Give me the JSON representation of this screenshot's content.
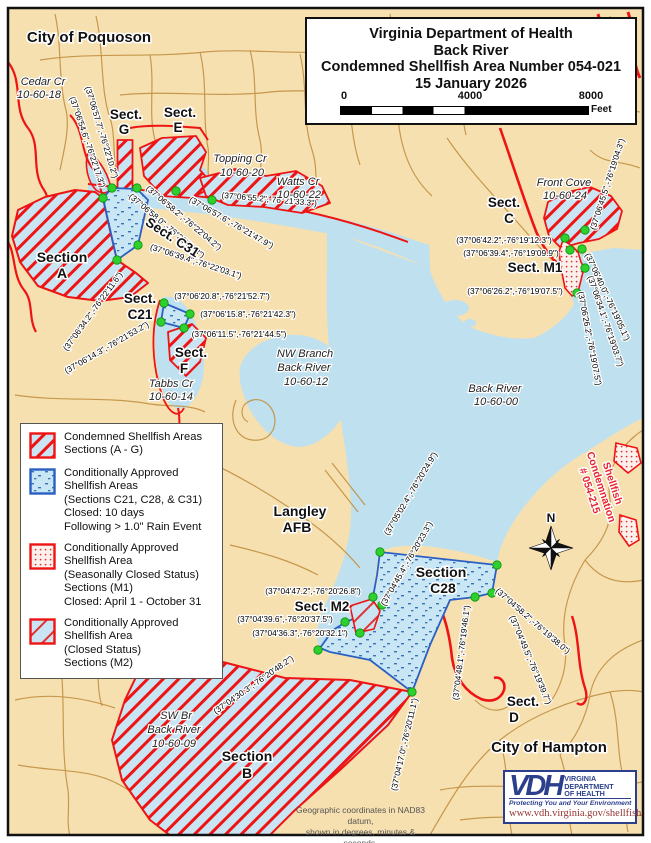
{
  "title_box": {
    "line1": "Virginia Department of Health",
    "line2": "Back River",
    "line3": "Condemned Shellfish Area Number 054-021",
    "line4": "15 January 2026",
    "scale": {
      "tick0": "0",
      "tick1": "4000",
      "tick2": "8000",
      "unit": "Feet"
    }
  },
  "legend": {
    "items": [
      {
        "swatch": "condemned",
        "lines": [
          "Condemned Shellfish Areas",
          "Sections (A - G)"
        ]
      },
      {
        "swatch": "rain",
        "lines": [
          "Conditionally Approved",
          "Shellfish Areas",
          "(Sections C21, C28, & C31)",
          "Closed: 10 days",
          "Following > 1.0\" Rain Event"
        ]
      },
      {
        "swatch": "seasonal",
        "lines": [
          "Conditionally Approved",
          "Shellfish Area",
          "(Seasonally Closed Status)",
          "Sections (M1)",
          "Closed: April 1 - October 31"
        ]
      },
      {
        "swatch": "m2",
        "lines": [
          "Conditionally Approved",
          "Shellfish Area",
          "(Closed Status)",
          "Sections (M2)"
        ]
      }
    ]
  },
  "footer_note": {
    "line1": "Geographic coordinates in NAD83 datum,",
    "line2": "shown in degrees, minutes & seconds."
  },
  "logo": {
    "acronym": "VDH",
    "org_lines": [
      "VIRGINIA",
      "DEPARTMENT",
      "OF HEALTH"
    ],
    "tagline": "Protecting You and Your Environment",
    "url": "www.vdh.virginia.gov/shellfish"
  },
  "compass": {
    "label": "N"
  },
  "colors": {
    "land": "#F7E0B0",
    "water": "#BFE0EF",
    "road": "#C49447",
    "condemned_red": "#EE1414",
    "boundary_blue": "#2A5FC4",
    "vertex_green": "#2ED02E",
    "condemn_text": "#E8252F",
    "logo_blue": "#2B3F8C",
    "url_red": "#943634"
  },
  "map": {
    "section_labels": [
      {
        "text": "City of Poquoson",
        "x": 89,
        "y": 42,
        "size": 15,
        "rot": 0
      },
      {
        "text": "Sect.",
        "x": 126,
        "y": 119,
        "size": 13.5,
        "rot": 0
      },
      {
        "text": "G",
        "x": 124,
        "y": 134,
        "size": 13.5,
        "rot": 0
      },
      {
        "text": "Sect.",
        "x": 180,
        "y": 117,
        "size": 13.5,
        "rot": 0
      },
      {
        "text": "E",
        "x": 178,
        "y": 132,
        "size": 13.5,
        "rot": 0
      },
      {
        "text": "Sect.",
        "x": 504,
        "y": 207,
        "size": 13.5,
        "rot": 0
      },
      {
        "text": "C",
        "x": 509,
        "y": 223,
        "size": 13.5,
        "rot": 0
      },
      {
        "text": "Section",
        "x": 62,
        "y": 262,
        "size": 14,
        "rot": 0
      },
      {
        "text": "A",
        "x": 62,
        "y": 278,
        "size": 14,
        "rot": 0
      },
      {
        "text": "Sect. C31",
        "x": 170,
        "y": 241,
        "size": 13.5,
        "rot": 33
      },
      {
        "text": "Sect.",
        "x": 140,
        "y": 303,
        "size": 13.5,
        "rot": 0
      },
      {
        "text": "C21",
        "x": 140,
        "y": 319,
        "size": 13.5,
        "rot": 0
      },
      {
        "text": "Sect.",
        "x": 191,
        "y": 357,
        "size": 13.5,
        "rot": 0
      },
      {
        "text": "F",
        "x": 184,
        "y": 373,
        "size": 13.5,
        "rot": 0
      },
      {
        "text": "Sect. M1",
        "x": 535,
        "y": 272,
        "size": 13.5,
        "rot": 0
      },
      {
        "text": "Langley",
        "x": 300,
        "y": 516,
        "size": 14,
        "rot": 0
      },
      {
        "text": "AFB",
        "x": 297,
        "y": 532,
        "size": 14,
        "rot": 0
      },
      {
        "text": "Section",
        "x": 441,
        "y": 577,
        "size": 14,
        "rot": 0
      },
      {
        "text": "C28",
        "x": 443,
        "y": 593,
        "size": 14,
        "rot": 0
      },
      {
        "text": "Sect. M2",
        "x": 322,
        "y": 611,
        "size": 13.5,
        "rot": 0
      },
      {
        "text": "Section",
        "x": 247,
        "y": 761,
        "size": 14,
        "rot": 0
      },
      {
        "text": "B",
        "x": 247,
        "y": 778,
        "size": 14,
        "rot": 0
      },
      {
        "text": "Sect.",
        "x": 523,
        "y": 706,
        "size": 13.5,
        "rot": 0
      },
      {
        "text": "D",
        "x": 514,
        "y": 722,
        "size": 13.5,
        "rot": 0
      },
      {
        "text": "City of Hampton",
        "x": 549,
        "y": 752,
        "size": 15,
        "rot": 0
      }
    ],
    "water_labels": [
      {
        "text": "Cedar Cr",
        "x": 43,
        "y": 85
      },
      {
        "text": "10-60-18",
        "x": 39,
        "y": 98
      },
      {
        "text": "Topping Cr",
        "x": 240,
        "y": 162
      },
      {
        "text": "10-60-20",
        "x": 242,
        "y": 176
      },
      {
        "text": "Watts Cr",
        "x": 298,
        "y": 185
      },
      {
        "text": "10-60-22",
        "x": 299,
        "y": 198
      },
      {
        "text": "Front Cove",
        "x": 564,
        "y": 186
      },
      {
        "text": "10-60-24",
        "x": 565,
        "y": 199
      },
      {
        "text": "NW Branch",
        "x": 305,
        "y": 357
      },
      {
        "text": "Back River",
        "x": 304,
        "y": 371
      },
      {
        "text": "10-60-12",
        "x": 306,
        "y": 385
      },
      {
        "text": "Back River",
        "x": 495,
        "y": 392
      },
      {
        "text": "10-60-00",
        "x": 496,
        "y": 405
      },
      {
        "text": "Tabbs Cr",
        "x": 171,
        "y": 387
      },
      {
        "text": "10-60-14",
        "x": 171,
        "y": 400
      },
      {
        "text": "SW Br",
        "x": 176,
        "y": 719
      },
      {
        "text": "Back River",
        "x": 174,
        "y": 733
      },
      {
        "text": "10-60-09",
        "x": 174,
        "y": 747
      }
    ],
    "coord_labels": [
      {
        "text": "(37°06'57.7\",-76°22'10.2\")",
        "x": 99,
        "y": 133,
        "rot": 73
      },
      {
        "text": "(37°06'54.6\",-76°22'17.3\")",
        "x": 85,
        "y": 143,
        "rot": 71
      },
      {
        "text": "(37°06'58.2\",-76°22'04.2\")",
        "x": 182,
        "y": 220,
        "rot": 40
      },
      {
        "text": "(37°06'58.0\",-76°22'09.3\")",
        "x": 165,
        "y": 228,
        "rot": 40
      },
      {
        "text": "(37°06'57.6\",-76°21'47.9\")",
        "x": 230,
        "y": 225,
        "rot": 30
      },
      {
        "text": "(37°06'55.2\",-76°21'33.3\")",
        "x": 269,
        "y": 202,
        "rot": 5
      },
      {
        "text": "(37°06'39.4\",-76°22'03.1\")",
        "x": 195,
        "y": 264,
        "rot": 18
      },
      {
        "text": "(37°06'34.2\",-76°22'11.6\")",
        "x": 95,
        "y": 313,
        "rot": -54
      },
      {
        "text": "(37°06'14.3\",-76°21'53.2\")",
        "x": 108,
        "y": 350,
        "rot": -30
      },
      {
        "text": "(37°06'20.8\",-76°21'52.7\")",
        "x": 222,
        "y": 299,
        "rot": 0
      },
      {
        "text": "(37°06'15.8\",-76°21'42.3\")",
        "x": 248,
        "y": 317,
        "rot": 0
      },
      {
        "text": "(37°06'11.5\",-76°21'44.5\")",
        "x": 239,
        "y": 337,
        "rot": 0
      },
      {
        "text": "(37°06'42.2\",-76°19'12.3\")",
        "x": 504,
        "y": 243,
        "rot": 0
      },
      {
        "text": "(37°06'39.4\",-76°19'09.9\")",
        "x": 511,
        "y": 256,
        "rot": 0
      },
      {
        "text": "(37°06'26.2\",-76°19'07.5\")",
        "x": 515,
        "y": 294,
        "rot": 0
      },
      {
        "text": "(37°06'45.5\",-76°19'04.3\")",
        "x": 610,
        "y": 185,
        "rot": -72
      },
      {
        "text": "(37°06'40.0\",-76°19'05.1\")",
        "x": 605,
        "y": 298,
        "rot": 65
      },
      {
        "text": "(37°06'34.1\",-76°19'03.7\")",
        "x": 603,
        "y": 322,
        "rot": 71
      },
      {
        "text": "(37°06'26.2\",-76°19'07.5\")",
        "x": 587,
        "y": 339,
        "rot": 79
      },
      {
        "text": "(37°05'02.4\",-76°20'24.9\")",
        "x": 413,
        "y": 495,
        "rot": -59
      },
      {
        "text": "(37°04'45.4\",-76°20'23.3\")",
        "x": 409,
        "y": 565,
        "rot": -60
      },
      {
        "text": "(37°04'47.2\",-76°20'26.8\")",
        "x": 313,
        "y": 594,
        "rot": 0
      },
      {
        "text": "(37°04'39.6\",-76°20'37.5\")",
        "x": 285,
        "y": 622,
        "rot": 0
      },
      {
        "text": "(37°04'36.3\",-76°20'32.1\")",
        "x": 300,
        "y": 636,
        "rot": 0
      },
      {
        "text": "(37°04'30.3\",-76°20'48.2\")",
        "x": 255,
        "y": 687,
        "rot": -35
      },
      {
        "text": "(37°04'58.2\",-76°19'38.0\")",
        "x": 531,
        "y": 623,
        "rot": 41
      },
      {
        "text": "(37°04'49.5\",-76°19'39.7\")",
        "x": 528,
        "y": 661,
        "rot": 67
      },
      {
        "text": "(37°04'48.1\",-76°19'46.1\")",
        "x": 464,
        "y": 653,
        "rot": -83
      },
      {
        "text": "(37°04'17.0\",-76°20'11.1\")",
        "x": 407,
        "y": 745,
        "rot": -77
      }
    ],
    "condemnation_note": {
      "lines": [
        "Shellfish",
        "Condemnation",
        "# 054-215"
      ],
      "x": 598,
      "y": 488,
      "rot": 72
    },
    "dots": [
      [
        112,
        188
      ],
      [
        137,
        188
      ],
      [
        176,
        191
      ],
      [
        212,
        200
      ],
      [
        103,
        198
      ],
      [
        117,
        260
      ],
      [
        138,
        245
      ],
      [
        164,
        303
      ],
      [
        161,
        322
      ],
      [
        184,
        328
      ],
      [
        190,
        314
      ],
      [
        565,
        238
      ],
      [
        570,
        250
      ],
      [
        582,
        249
      ],
      [
        585,
        230
      ],
      [
        585,
        268
      ],
      [
        577,
        293
      ],
      [
        380,
        552
      ],
      [
        497,
        565
      ],
      [
        492,
        593
      ],
      [
        475,
        597
      ],
      [
        412,
        692
      ],
      [
        373,
        597
      ],
      [
        382,
        605
      ],
      [
        345,
        622
      ],
      [
        360,
        633
      ],
      [
        318,
        650
      ]
    ]
  }
}
